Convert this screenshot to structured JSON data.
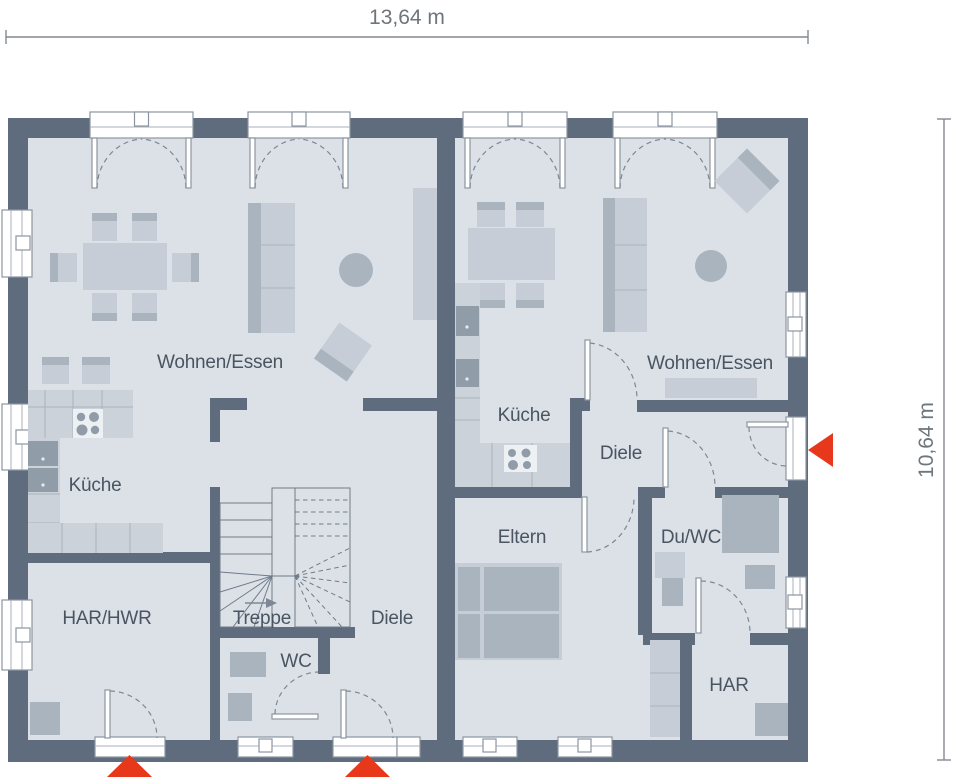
{
  "dimensions": {
    "width": "13,64 m",
    "height": "10,64 m"
  },
  "units": {
    "left": {
      "living": "Wohnen/Essen",
      "kitchen": "Küche",
      "utility": "HAR/HWR",
      "stair": "Treppe",
      "hall": "Diele",
      "wc": "WC"
    },
    "right": {
      "living": "Wohnen/Essen",
      "kitchen": "Küche",
      "hall": "Diele",
      "parents": "Eltern",
      "shower_wc": "Du/WC",
      "storage": "HAR"
    }
  },
  "colors": {
    "wall": "#5e6c7d",
    "floor": "#dce1e8",
    "furn_light": "#c6cdd6",
    "furn_mid": "#aab4bf",
    "furn_dark": "#919ca9",
    "counter": "#ccd2d9",
    "counter_line": "#a9b2bc",
    "opening_stroke": "#8b95a0",
    "arc": "#7e8894",
    "stair_line": "#6f7b88",
    "label": "#4a5561",
    "dim_line": "#84898e",
    "dim_text": "#6e757b",
    "accent_red": "#e8381c"
  }
}
